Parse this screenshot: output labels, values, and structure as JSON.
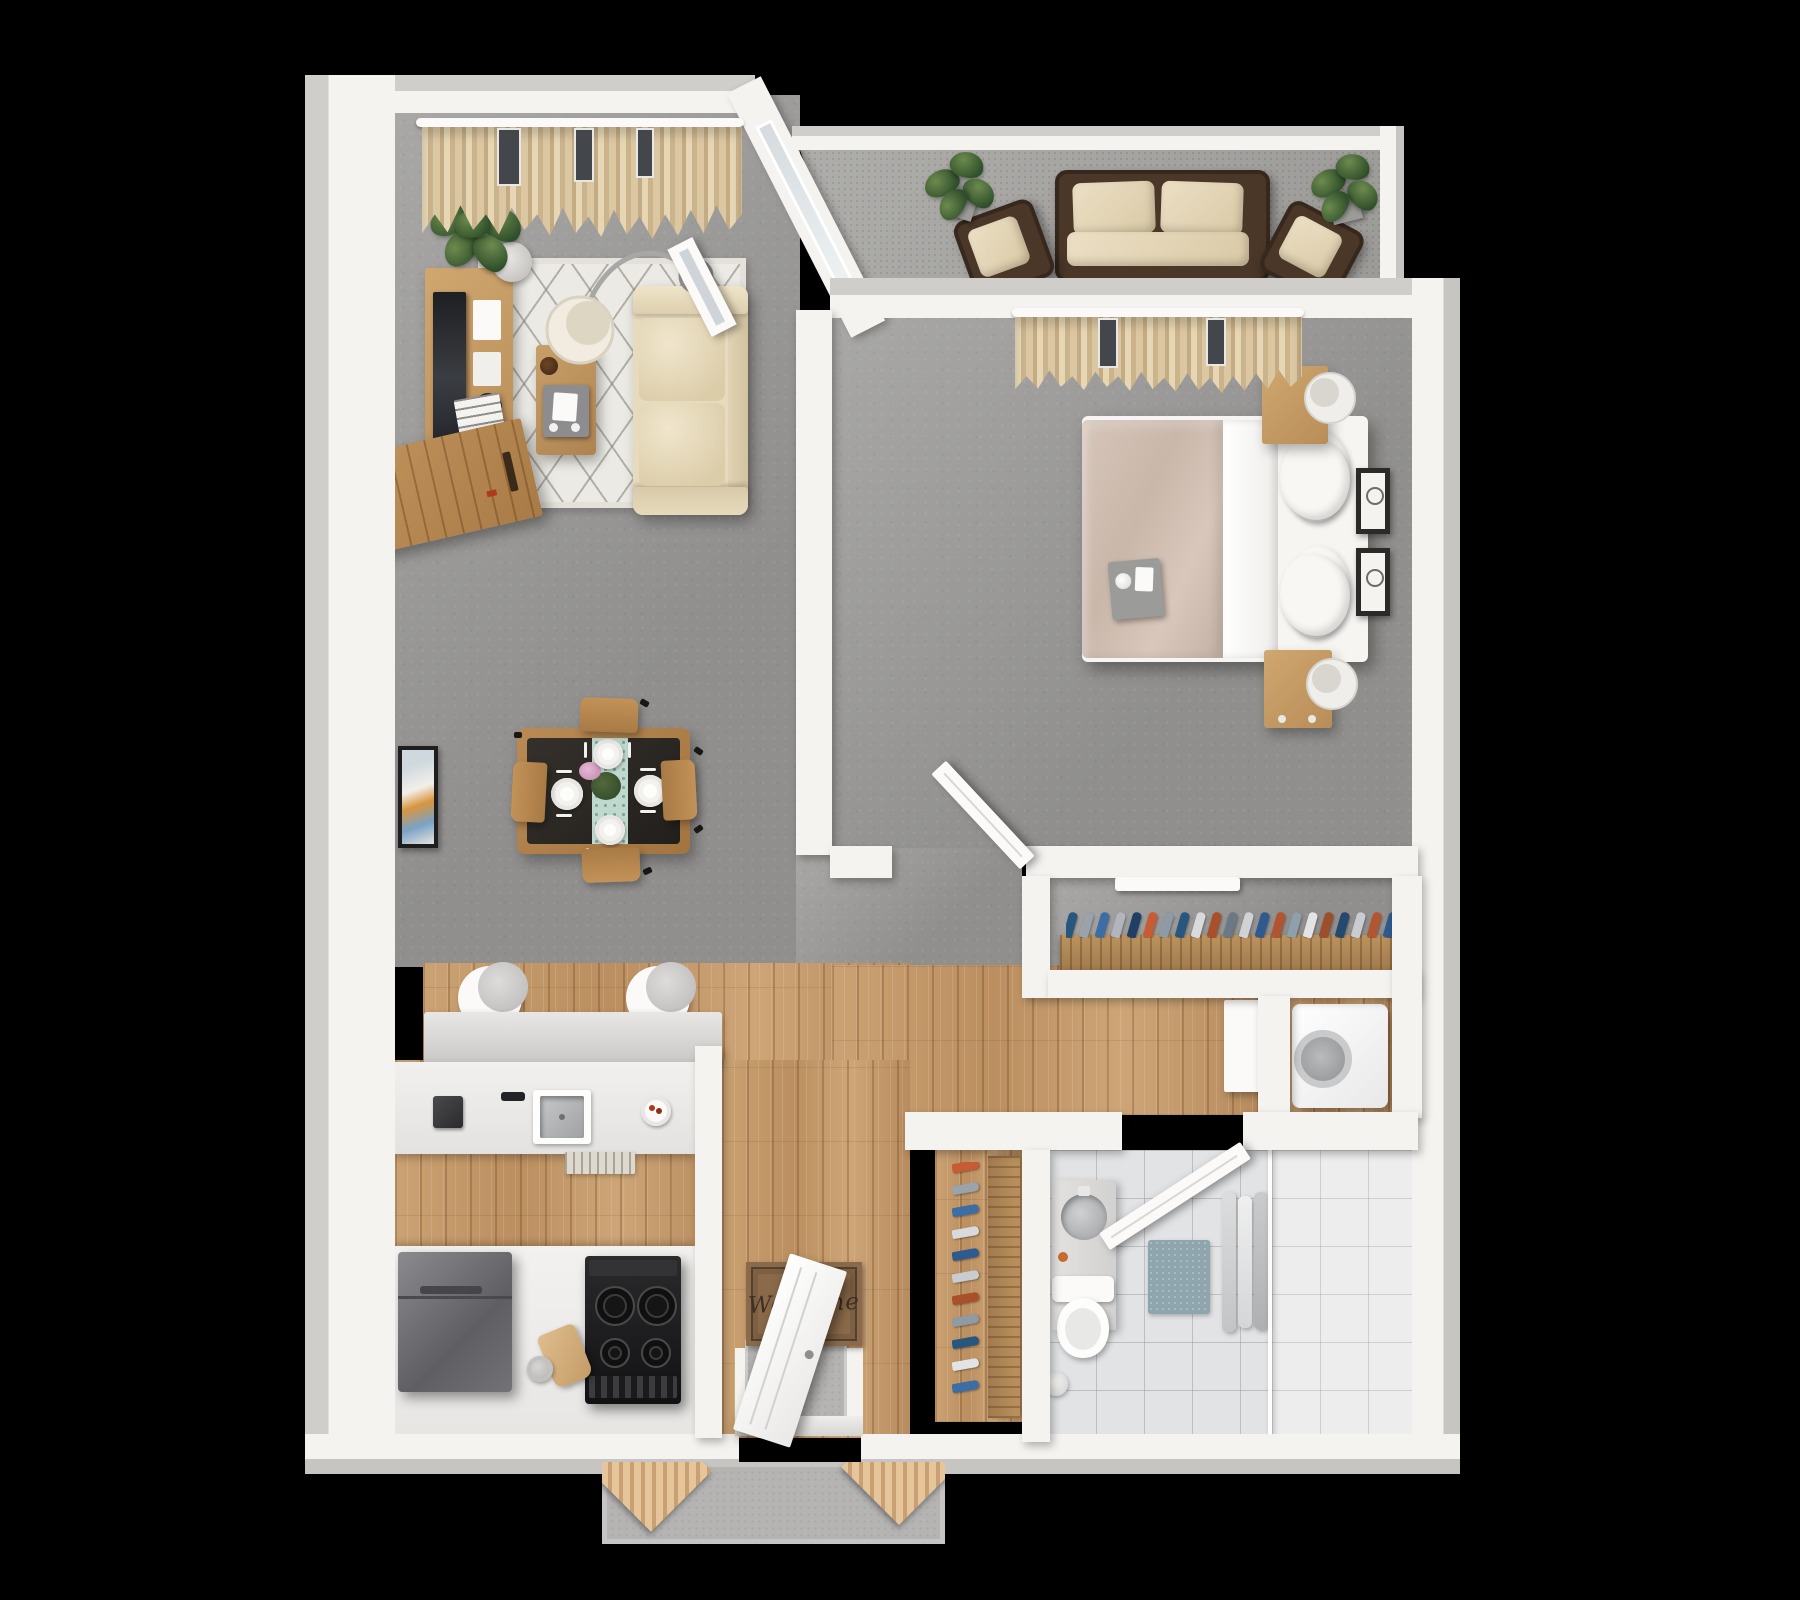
{
  "scene": {
    "description": "3D top-down rendered floor plan of a one-bedroom, one-bathroom apartment with balcony and entry stoop",
    "background_color": "#000000",
    "view": "top-down-3d"
  },
  "text": {
    "welcome_mat": "Welcome"
  },
  "palette": {
    "wall": "#f4f3f0",
    "wall_outer": "#c9c8c5",
    "carpet_gray": "#9b9a98",
    "wood_floor": "#c49a6c",
    "bathroom_tile": "#e2e3e5",
    "outdoor_carpet": "#a5a4a1",
    "concrete": "#b5b4b2",
    "curtain_beige": "#d8c5a0",
    "sofa_cream": "#e7dbbf",
    "furniture_wood": "#b8854f",
    "wicker_brown": "#4a3728",
    "appliance_dark": "#1c1c1e",
    "bath_mat_blue": "#8fa5ad",
    "bed_duvet": "#cdbbae",
    "runner_teal": "#bfd9cf"
  },
  "rooms": [
    {
      "id": "living-room",
      "floor": "carpet",
      "contents": [
        "window-curtains",
        "curtain-rail",
        "floor-plant",
        "tv-console",
        "tv",
        "storage-cabinet",
        "area-rug",
        "coffee-table",
        "serving-tray",
        "arc-floor-lamp",
        "sofa",
        "magazines"
      ]
    },
    {
      "id": "dining-area",
      "floor": "carpet",
      "contents": [
        "dining-table",
        "dining-chairs",
        "place-settings",
        "table-runner",
        "flower-centerpiece",
        "wall-art"
      ]
    },
    {
      "id": "kitchen",
      "floor": "wood",
      "contents": [
        "breakfast-bar",
        "bar-stools",
        "kitchen-sink",
        "faucet",
        "toaster",
        "fruit-bowl",
        "kitchen-runner-rug",
        "refrigerator",
        "stove",
        "cutting-board",
        "utensil-jar",
        "base-cabinets"
      ]
    },
    {
      "id": "entry",
      "floor": "wood",
      "contents": [
        "entry-door",
        "welcome-mat",
        "entry-pad",
        "door-threshold"
      ]
    },
    {
      "id": "hallway",
      "floor": "wood",
      "contents": []
    },
    {
      "id": "bedroom",
      "floor": "carpet",
      "contents": [
        "double-bed",
        "duvet",
        "pillows",
        "breakfast-tray",
        "nightstand-top",
        "nightstand-bottom",
        "table-lamps",
        "window-curtains",
        "curtain-rail",
        "wall-frames",
        "bedroom-door"
      ]
    },
    {
      "id": "bedroom-closet",
      "floor": "carpet",
      "contents": [
        "closet-rod",
        "hanging-clothes",
        "sliding-door-track"
      ]
    },
    {
      "id": "coat-closet",
      "floor": "wood",
      "contents": [
        "closet-rod",
        "hanging-clothes"
      ]
    },
    {
      "id": "bathroom",
      "floor": "tile",
      "contents": [
        "vanity",
        "vessel-sink",
        "toilet",
        "waste-bin",
        "bath-mat",
        "towels",
        "shower",
        "glass-partition",
        "bathroom-door"
      ]
    },
    {
      "id": "laundry-nook",
      "floor": "wood",
      "contents": [
        "washer",
        "cabinet-panel"
      ]
    },
    {
      "id": "balcony",
      "floor": "outdoor-carpet",
      "contents": [
        "outdoor-sofa",
        "outdoor-chair-left",
        "outdoor-chair-right",
        "potted-plant-left",
        "potted-plant-right",
        "sliding-glass-door"
      ]
    },
    {
      "id": "patio-stoop",
      "floor": "concrete",
      "contents": [
        "wood-chair-left",
        "wood-chair-right"
      ]
    }
  ],
  "closets": {
    "bedroom_clothes_colors": [
      "#27567f",
      "#9aa2aa",
      "#3a6ea5",
      "#b0b6bc",
      "#1f3f66",
      "#c75b33",
      "#8f9aa4",
      "#27567f",
      "#d8dadc",
      "#a94f2a",
      "#6b7886",
      "#cfd3d6",
      "#2e5a8f",
      "#b35430",
      "#8fa0ad",
      "#e2e3e4",
      "#9d4f2c",
      "#24496e",
      "#c9ccd0",
      "#b25531",
      "#2e5a8f",
      "#d8dadc"
    ],
    "coat_clothes_colors": [
      "#c75b33",
      "#9aa2aa",
      "#3a6ea5",
      "#d8dadc",
      "#2e5a8f",
      "#c9ccd0",
      "#a94f2a",
      "#8f9aa4",
      "#27567f",
      "#e2e3e4",
      "#3a6ea5"
    ]
  },
  "dining": {
    "place_setting_count": 4,
    "chair_count": 4
  }
}
